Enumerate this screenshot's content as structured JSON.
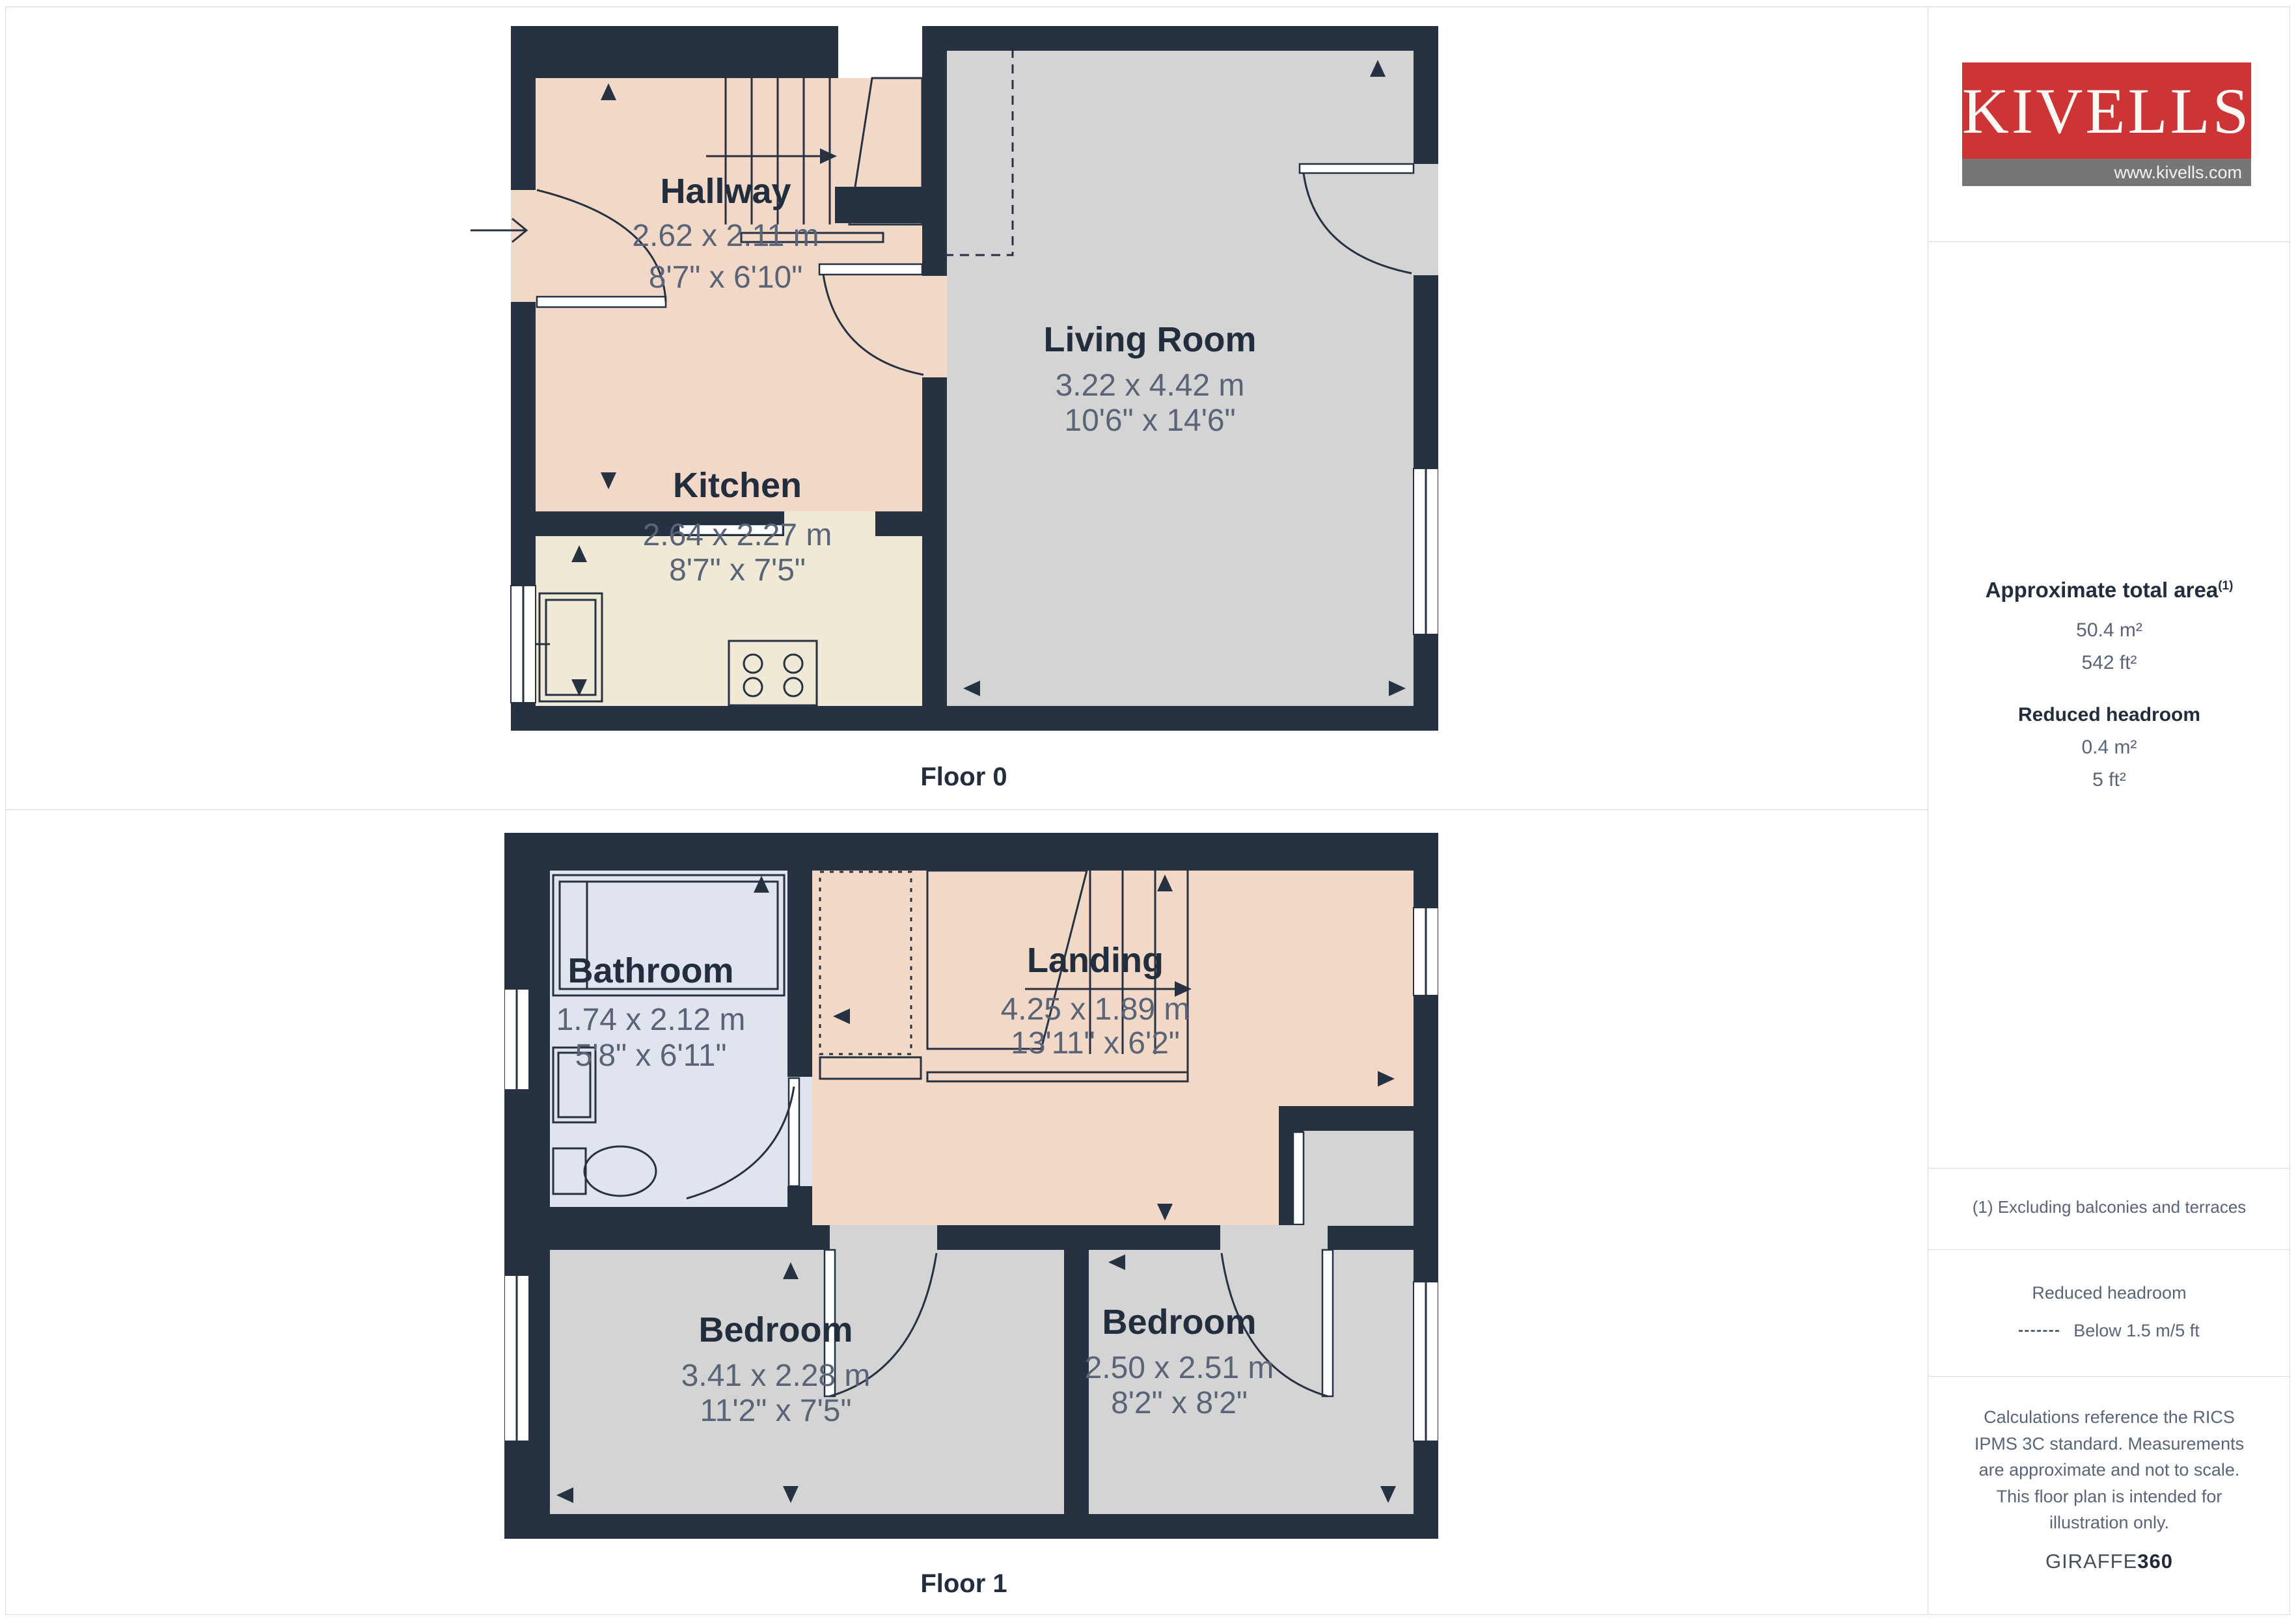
{
  "logo": {
    "brand": "KIVELLS",
    "website": "www.kivells.com"
  },
  "floors": [
    {
      "label": "Floor 0",
      "rooms": [
        {
          "name": "Hallway",
          "metric": "2.62 x 2.11 m",
          "imperial": "8'7\" x 6'10\""
        },
        {
          "name": "Kitchen",
          "metric": "2.64 x 2.27 m",
          "imperial": "8'7\" x 7'5\""
        },
        {
          "name": "Living Room",
          "metric": "3.22 x 4.42 m",
          "imperial": "10'6\" x 14'6\""
        }
      ]
    },
    {
      "label": "Floor 1",
      "rooms": [
        {
          "name": "Bathroom",
          "metric": "1.74 x 2.12 m",
          "imperial": "5'8\" x 6'11\""
        },
        {
          "name": "Landing",
          "metric": "4.25 x 1.89 m",
          "imperial": "13'11\" x 6'2\""
        },
        {
          "name": "Bedroom",
          "metric": "3.41 x 2.28 m",
          "imperial": "11'2\" x 7'5\""
        },
        {
          "name": "Bedroom",
          "metric": "2.50 x 2.51 m",
          "imperial": "8'2\" x 8'2\""
        }
      ]
    }
  ],
  "sidebar": {
    "total_area": {
      "heading": "Approximate total area",
      "footnote_marker": "(1)",
      "metric": "50.4 m²",
      "imperial": "542 ft²"
    },
    "reduced_headroom": {
      "heading": "Reduced headroom",
      "metric": "0.4 m²",
      "imperial": "5 ft²"
    },
    "footnote": "(1) Excluding balconies and terraces",
    "legend": {
      "heading": "Reduced headroom",
      "item": "Below 1.5 m/5 ft"
    },
    "disclaimer": "Calculations reference the RICS IPMS 3C standard. Measurements are approximate and not to scale. This floor plan is intended for illustration only.",
    "generator": {
      "name": "GIRAFFE",
      "suffix": "360"
    }
  },
  "colors": {
    "wall": "#263142",
    "hallway": "#f1d8c7",
    "kitchen": "#efe9d5",
    "living_room": "#d4d4d4",
    "bathroom": "#dfe4ef",
    "bedroom": "#d4d4d4",
    "logo_red": "#cd3435",
    "logo_grey": "#767676",
    "room_name_text": "#222d3e",
    "dimension_text": "#5a6478",
    "divider": "#d9d9d9"
  }
}
